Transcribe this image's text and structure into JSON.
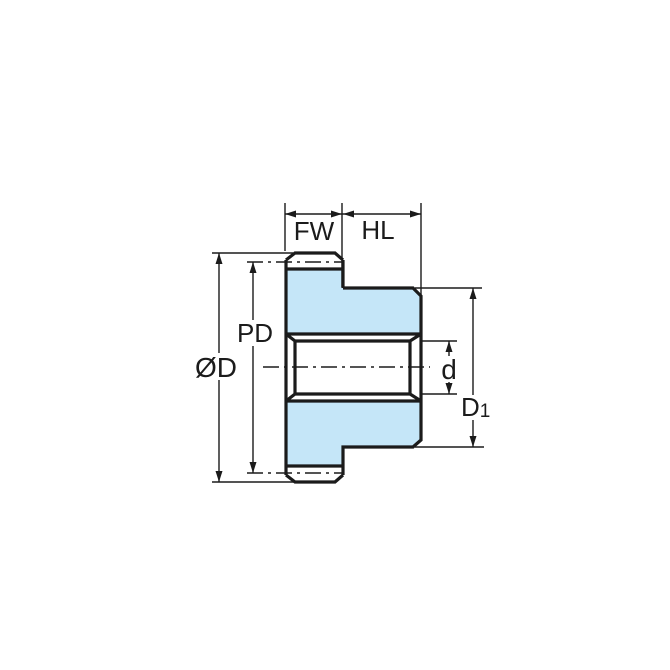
{
  "diagram": {
    "kind": "gear-cross-section-dimension-drawing",
    "labels": {
      "face_width": "FW",
      "hub_length": "HL",
      "pitch_diameter": "PD",
      "outside_diameter": "ØD",
      "bore_diameter": "d",
      "hub_diameter_base": "D",
      "hub_diameter_subscript": "1"
    },
    "colors": {
      "part_fill": "#C5E6F8",
      "line": "#1b1b1b",
      "background": "#FFFFFF"
    }
  }
}
